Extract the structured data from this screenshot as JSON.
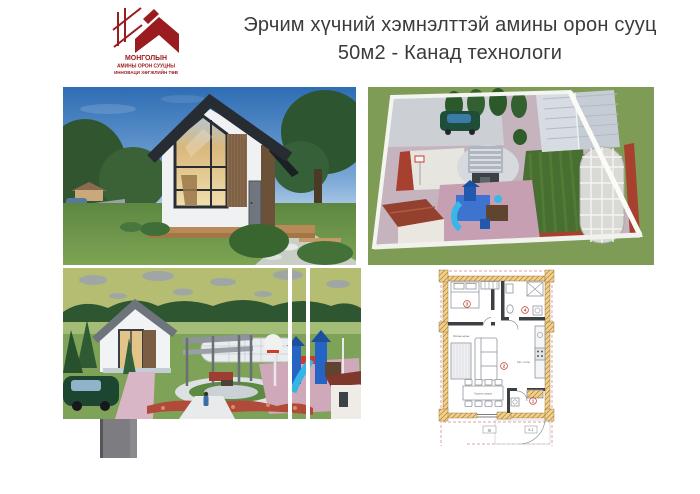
{
  "header": {
    "logo": {
      "line1": "МОНГОЛЫН",
      "line2": "АМИНЫ ОРОН СУУЦНЫ",
      "line3": "ИННОВАЦИ ХӨГЖЛИЙН ТӨВ"
    },
    "title_line1": "Эрчим хүчний хэмнэлттэй амины орон сууц",
    "title_line2": "50м2 - Канад технологи"
  },
  "icons": {
    "logo_icon": "house-roof-icon"
  },
  "colors": {
    "brand_red": "#9a1c20",
    "title_text": "#3b3b3b",
    "plan_wall_fill": "#f0d08e",
    "plan_dimension_red": "#cc4444",
    "sky_blue": "#2e6db4",
    "grass_green": "#7e9c55",
    "playground_blue": "#2f6fd2"
  },
  "floor_plan": {
    "room_numbers": {
      "entry": "1",
      "living": "2",
      "bedroom": "3",
      "bathroom": "4"
    },
    "labels": {
      "living_room": "Зочны өрөө",
      "kitchen": "Гал тогоо",
      "dining_table": "Хоолны ширээ"
    },
    "marks": {
      "sheet_center": "Ш",
      "sheet_right": "К-1"
    }
  }
}
